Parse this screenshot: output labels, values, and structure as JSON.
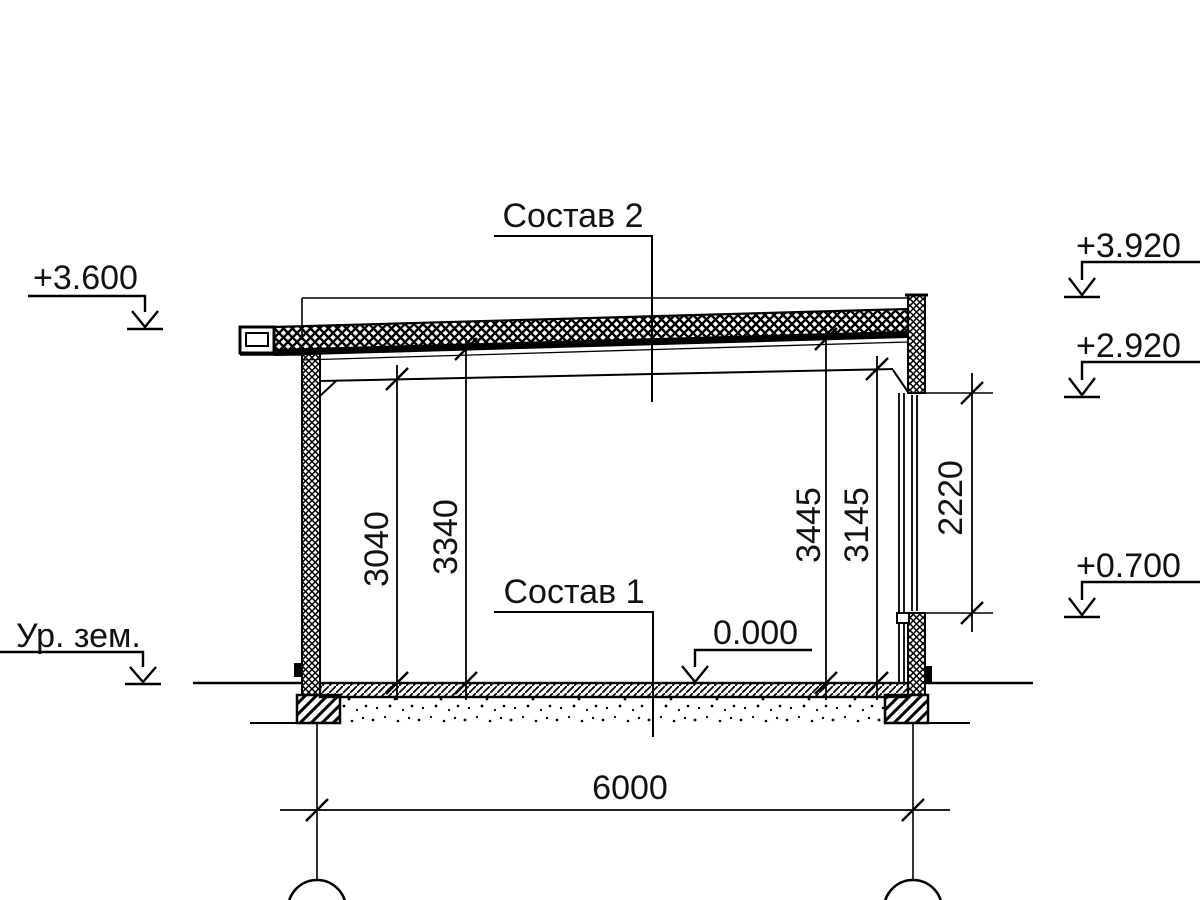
{
  "drawing": {
    "type": "architectural-section",
    "labels": {
      "sostav2": "Состав 2",
      "sostav1": "Состав 1",
      "ground": "Ур. зем."
    },
    "elevations": {
      "roof_left": "+3.600",
      "parapet_top": "+3.920",
      "opening_top": "+2.920",
      "opening_sill": "+0.700",
      "floor_zero": "0.000"
    },
    "dimensions": {
      "floor_to_ceiling_left": "3040",
      "floor_to_roof_left": "3340",
      "floor_to_roof_right": "3445",
      "floor_to_ceiling_right": "3145",
      "opening_height": "2220",
      "span": "6000"
    },
    "colors": {
      "ink": "#000000",
      "paper": "#ffffff"
    }
  }
}
